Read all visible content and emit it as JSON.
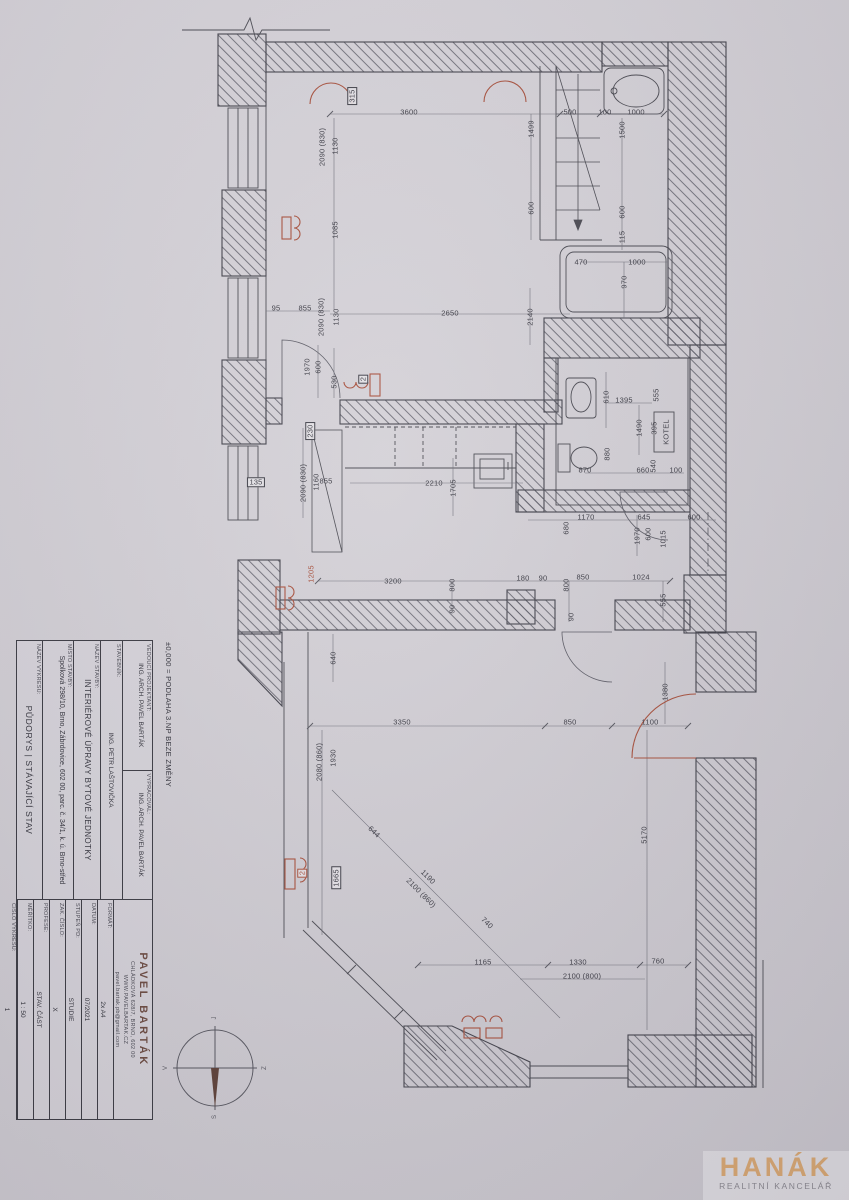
{
  "title_block": {
    "elevation_note": "±0,000 = PODLAHA 3.NP BEZE ZMĚNY",
    "fields": [
      {
        "label": "VEDOUCÍ PROJEKTANT:",
        "value": "ING. ARCH. PAVEL BARTÁK"
      },
      {
        "label": "VYPRACOVAL:",
        "value": "ING. ARCH. PAVEL BARTÁK"
      },
      {
        "label": "STAVEBNÍK:",
        "value": "ING. PETR LAŠTOVIČKA"
      },
      {
        "label": "NÁZEV STAVBY:",
        "value": "INTERIÉROVÉ ÚPRAVY BYTOVÉ JEDNOTKY"
      },
      {
        "label": "MÍSTO STAVBY:",
        "value": "Spolková 298/10, Brno, Zábrdovice, 602 00, parc. č. 34/1, k. ú. Brno-střed"
      },
      {
        "label": "NÁZEV VÝKRESU:",
        "value": "PŮDORYS | STÁVAJÍCÍ STAV"
      }
    ],
    "contact": {
      "name": "PAVEL BARTÁK",
      "address": "CHLÁDKOVÁ 628/7, BRNO, 602 00",
      "web": "WWW.PAVELBARTAK.CZ",
      "email": "pavel.bartak.pb@gmail.com"
    },
    "meta": [
      {
        "label": "FORMÁT:",
        "value": "2x A4"
      },
      {
        "label": "DATUM:",
        "value": "07/2021"
      },
      {
        "label": "STUPEŇ PD:",
        "value": "STUDIE"
      },
      {
        "label": "ZAK. ČÍSLO:",
        "value": "X"
      },
      {
        "label": "PROFESE:",
        "value": "STAV. ČÁST"
      },
      {
        "label": "MĚŘÍTKO:",
        "value": "1 : 50"
      },
      {
        "label": "ČÍSLO VÝKRESU:",
        "value": "1"
      }
    ]
  },
  "compass": {
    "top": "J",
    "right": "Z",
    "bottom": "S",
    "left": "V"
  },
  "watermark": {
    "brand": "HANÁK",
    "tagline": "REALITNÍ KANCELÁŘ"
  },
  "colors": {
    "ink": "#3c3c45",
    "red": "#a8503c",
    "paper": "#d3d0d6",
    "brand_orange": "#d9a873"
  },
  "plan": {
    "labels": [
      {
        "t": "315",
        "x": 352,
        "y": 96,
        "r": "v",
        "b": true
      },
      {
        "t": "3600",
        "x": 409,
        "y": 112
      },
      {
        "t": "1130",
        "x": 335,
        "y": 146,
        "r": "v"
      },
      {
        "t": "2090 (830)",
        "x": 322,
        "y": 147,
        "r": "v"
      },
      {
        "t": "1499",
        "x": 531,
        "y": 129,
        "r": "v"
      },
      {
        "t": "500",
        "x": 570,
        "y": 112
      },
      {
        "t": "100",
        "x": 605,
        "y": 112
      },
      {
        "t": "1000",
        "x": 636,
        "y": 112
      },
      {
        "t": "1500",
        "x": 622,
        "y": 130,
        "r": "v"
      },
      {
        "t": "600",
        "x": 531,
        "y": 208,
        "r": "v"
      },
      {
        "t": "600",
        "x": 622,
        "y": 212,
        "r": "v"
      },
      {
        "t": "115",
        "x": 622,
        "y": 237,
        "r": "v"
      },
      {
        "t": "470",
        "x": 581,
        "y": 262
      },
      {
        "t": "1000",
        "x": 637,
        "y": 262
      },
      {
        "t": "970",
        "x": 624,
        "y": 282,
        "r": "v"
      },
      {
        "t": "1085",
        "x": 335,
        "y": 230,
        "r": "v"
      },
      {
        "t": "95",
        "x": 276,
        "y": 308
      },
      {
        "t": "855",
        "x": 305,
        "y": 308
      },
      {
        "t": "2090 (830)",
        "x": 321,
        "y": 317,
        "r": "v"
      },
      {
        "t": "1130",
        "x": 336,
        "y": 317,
        "r": "v"
      },
      {
        "t": "2650",
        "x": 450,
        "y": 313
      },
      {
        "t": "2140",
        "x": 530,
        "y": 317,
        "r": "v"
      },
      {
        "t": "600",
        "x": 318,
        "y": 367,
        "r": "v"
      },
      {
        "t": "1970",
        "x": 307,
        "y": 367,
        "r": "v"
      },
      {
        "t": "530",
        "x": 334,
        "y": 382,
        "r": "v"
      },
      {
        "t": "2",
        "x": 363,
        "y": 379,
        "r": "v",
        "b": true
      },
      {
        "t": "230",
        "x": 310,
        "y": 431,
        "r": "v",
        "b": true
      },
      {
        "t": "135",
        "x": 256,
        "y": 482,
        "b": true
      },
      {
        "t": "2090 (830)",
        "x": 303,
        "y": 483,
        "r": "v"
      },
      {
        "t": "1160",
        "x": 316,
        "y": 482,
        "r": "v"
      },
      {
        "t": "855",
        "x": 326,
        "y": 481
      },
      {
        "t": "2210",
        "x": 434,
        "y": 483
      },
      {
        "t": "1705",
        "x": 453,
        "y": 488,
        "r": "v"
      },
      {
        "t": "610",
        "x": 606,
        "y": 397,
        "r": "v"
      },
      {
        "t": "1395",
        "x": 624,
        "y": 400
      },
      {
        "t": "555",
        "x": 656,
        "y": 395,
        "r": "v"
      },
      {
        "t": "1490",
        "x": 639,
        "y": 428,
        "r": "v"
      },
      {
        "t": "395",
        "x": 654,
        "y": 428,
        "r": "v"
      },
      {
        "t": "KOTEL",
        "x": 666,
        "y": 432,
        "r": "v"
      },
      {
        "t": "880",
        "x": 607,
        "y": 454,
        "r": "v"
      },
      {
        "t": "870",
        "x": 585,
        "y": 470
      },
      {
        "t": "660",
        "x": 643,
        "y": 470
      },
      {
        "t": "540",
        "x": 653,
        "y": 466,
        "r": "v"
      },
      {
        "t": "100",
        "x": 676,
        "y": 470
      },
      {
        "t": "1170",
        "x": 586,
        "y": 517
      },
      {
        "t": "680",
        "x": 566,
        "y": 528,
        "r": "v"
      },
      {
        "t": "645",
        "x": 644,
        "y": 517
      },
      {
        "t": "600",
        "x": 694,
        "y": 517
      },
      {
        "t": "1970",
        "x": 637,
        "y": 536,
        "r": "v"
      },
      {
        "t": "600",
        "x": 648,
        "y": 534,
        "r": "v"
      },
      {
        "t": "1015",
        "x": 663,
        "y": 539,
        "r": "v"
      },
      {
        "t": "180",
        "x": 523,
        "y": 578
      },
      {
        "t": "90",
        "x": 543,
        "y": 578
      },
      {
        "t": "850",
        "x": 583,
        "y": 577
      },
      {
        "t": "1024",
        "x": 641,
        "y": 577
      },
      {
        "t": "800",
        "x": 566,
        "y": 585,
        "r": "v"
      },
      {
        "t": "555",
        "x": 663,
        "y": 600,
        "r": "v"
      },
      {
        "t": "90",
        "x": 571,
        "y": 617,
        "r": "v"
      },
      {
        "t": "1205",
        "x": 311,
        "y": 574,
        "r": "v",
        "c": "red"
      },
      {
        "t": "3200",
        "x": 393,
        "y": 581
      },
      {
        "t": "800",
        "x": 452,
        "y": 585,
        "r": "v"
      },
      {
        "t": "90",
        "x": 452,
        "y": 609,
        "r": "v"
      },
      {
        "t": "640",
        "x": 333,
        "y": 658,
        "r": "v"
      },
      {
        "t": "1380",
        "x": 665,
        "y": 692,
        "r": "v"
      },
      {
        "t": "3350",
        "x": 402,
        "y": 722
      },
      {
        "t": "850",
        "x": 570,
        "y": 722
      },
      {
        "t": "1100",
        "x": 650,
        "y": 722
      },
      {
        "t": "1930",
        "x": 333,
        "y": 758,
        "r": "v"
      },
      {
        "t": "2080 (860)",
        "x": 319,
        "y": 762,
        "r": "v"
      },
      {
        "t": "5170",
        "x": 644,
        "y": 835,
        "r": "v"
      },
      {
        "t": "644",
        "x": 374,
        "y": 832,
        "r": "d"
      },
      {
        "t": "1190",
        "x": 428,
        "y": 877,
        "r": "d"
      },
      {
        "t": "2100 (860)",
        "x": 421,
        "y": 893,
        "r": "d"
      },
      {
        "t": "740",
        "x": 487,
        "y": 923,
        "r": "d"
      },
      {
        "t": "1665",
        "x": 336,
        "y": 878,
        "r": "v",
        "b": true
      },
      {
        "t": "2",
        "x": 302,
        "y": 873,
        "r": "v",
        "c": "red",
        "b": true
      },
      {
        "t": "1165",
        "x": 483,
        "y": 962
      },
      {
        "t": "1330",
        "x": 578,
        "y": 962
      },
      {
        "t": "760",
        "x": 658,
        "y": 961
      },
      {
        "t": "2100 (800)",
        "x": 582,
        "y": 976
      }
    ]
  }
}
